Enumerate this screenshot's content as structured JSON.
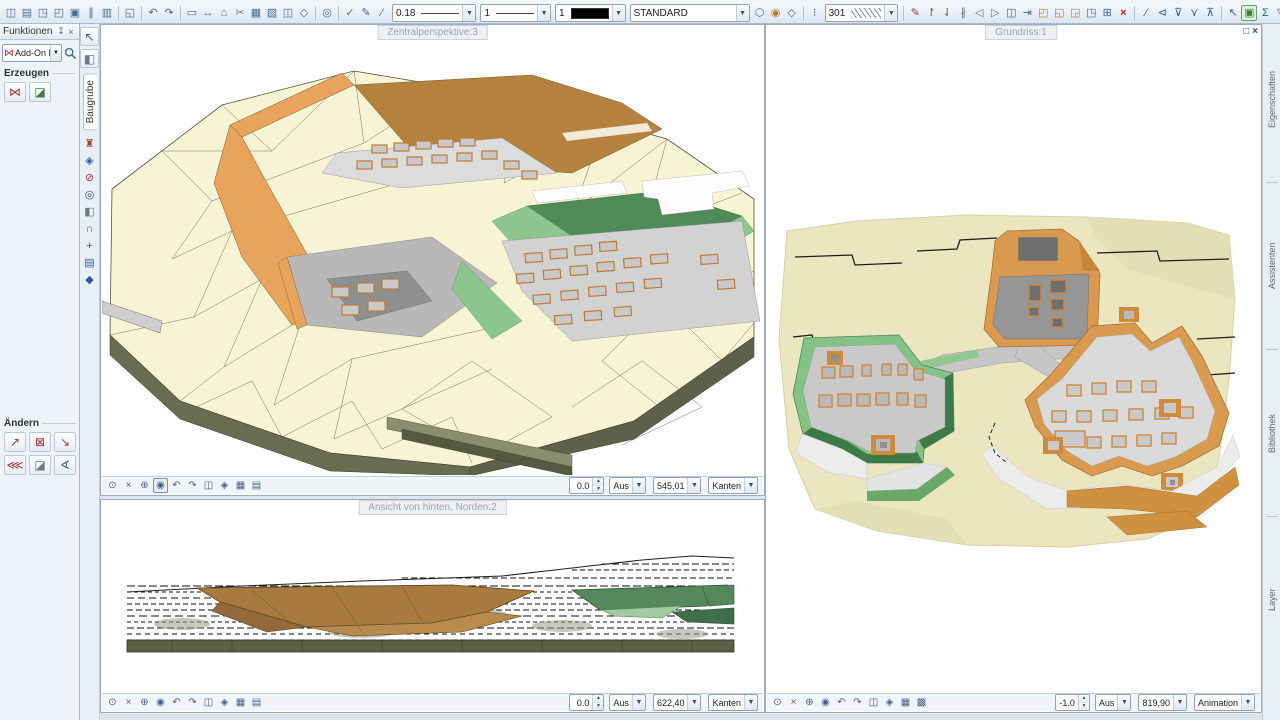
{
  "toolbar": {
    "pen_width": "0.18",
    "line_type": "1",
    "pen_color": "1",
    "layer_name": "STANDARD",
    "hatch_number": "301"
  },
  "palette": {
    "title": "Funktionen",
    "addon_dropdown": "Add-On Modul",
    "section_create": "Erzeugen",
    "section_modify": "Ändern",
    "module_tab": "Baugrube"
  },
  "right_tabs": [
    "Eigenschaften",
    "Assistenten",
    "Bibliothek",
    "Layer"
  ],
  "viewports": [
    {
      "title": "Zentralperspektive:3",
      "tilt": "0.0",
      "mode1": "Aus",
      "scale": "545,01",
      "mode2": "Kanten"
    },
    {
      "title": "Ansicht von hinten, Norden:2",
      "tilt": "0.0",
      "mode1": "Aus",
      "scale": "622,40",
      "mode2": "Kanten"
    },
    {
      "title": "Grundriss:1",
      "tilt": "-1.0",
      "mode1": "Aus",
      "scale": "819,90",
      "mode2": "Animation"
    }
  ],
  "window_buttons": {
    "maximize": "□",
    "close": "×"
  },
  "colors": {
    "terrain": "#f6f3d6",
    "terrain_side": "#6b7054",
    "wall_orange": "#e2a259",
    "plateau_brown": "#b5813f",
    "slab_gray": "#d6d6d6",
    "green_dark": "#4f8a58",
    "green_light": "#8cc68c",
    "toolbar_accent": "#4a6a92",
    "delete_red": "#cc1414"
  },
  "icons": {
    "file": [
      {
        "n": "new-document-icon",
        "g": "◫"
      },
      {
        "n": "open-project-icon",
        "g": "▤"
      },
      {
        "n": "copy-document-icon",
        "g": "◳"
      },
      {
        "n": "open-folder-icon",
        "g": "◰"
      },
      {
        "n": "save-icon",
        "g": "▣"
      },
      {
        "n": "import-export-icon",
        "g": "∥"
      },
      {
        "n": "project-pilot-icon",
        "g": "▥"
      }
    ],
    "screen": [
      {
        "n": "screen-layout-icon",
        "g": "◱"
      }
    ],
    "undoredo": [
      {
        "n": "undo-icon",
        "g": "↶"
      },
      {
        "n": "redo-icon",
        "g": "↷"
      }
    ],
    "clipboard": [
      {
        "n": "ruler-icon",
        "g": "▭"
      },
      {
        "n": "measure-tape-icon",
        "g": "↔"
      },
      {
        "n": "roof-tool-icon",
        "g": "⌂"
      },
      {
        "n": "cut-icon",
        "g": "✂",
        "c": "gray"
      },
      {
        "n": "copy-image-icon",
        "g": "▦"
      },
      {
        "n": "paste-image-icon",
        "g": "▧"
      },
      {
        "n": "paste-special-icon",
        "g": "◫"
      },
      {
        "n": "3d-body-icon",
        "g": "◇"
      }
    ],
    "zoomfind": [
      {
        "n": "find-icon",
        "g": "◎"
      }
    ],
    "pens": [
      {
        "n": "format-check-icon",
        "g": "✓",
        "c": "green"
      },
      {
        "n": "format-pen-icon",
        "g": "✎"
      },
      {
        "n": "format-stroke-icon",
        "g": "∕"
      }
    ],
    "surface": [
      {
        "n": "surface-style-icon",
        "g": "⬡"
      },
      {
        "n": "light-icon",
        "g": "◉",
        "c": "orange"
      },
      {
        "n": "texture-icon",
        "g": "◇"
      }
    ],
    "hatchpre": [
      {
        "n": "hatch-link-icon",
        "g": "⁝",
        "c": "blue"
      }
    ],
    "edit": [
      {
        "n": "edit-pen-icon",
        "g": "✎",
        "c": "red"
      },
      {
        "n": "pin-tool-icon",
        "g": "↾",
        "c": "red"
      },
      {
        "n": "hook-tool-icon",
        "g": "⇃",
        "c": "red"
      },
      {
        "n": "parallel-icon",
        "g": "∦",
        "c": "gray"
      },
      {
        "n": "mirror-left-icon",
        "g": "◁",
        "c": "gray"
      },
      {
        "n": "mirror-right-icon",
        "g": "▷",
        "c": "gray"
      },
      {
        "n": "copy-icon",
        "g": "◫"
      },
      {
        "n": "move-icon",
        "g": "⇥"
      },
      {
        "n": "rotate-icon",
        "g": "◰",
        "c": "orange"
      },
      {
        "n": "copy-mirror-icon",
        "g": "◱",
        "c": "orange"
      },
      {
        "n": "stretch-icon",
        "g": "◲",
        "c": "orange"
      },
      {
        "n": "align-icon",
        "g": "◳"
      },
      {
        "n": "resize-icon",
        "g": "⊞"
      },
      {
        "n": "delete-icon",
        "g": "×",
        "c": "delete"
      }
    ],
    "filter": [
      {
        "n": "filter-pen-icon",
        "g": "∕",
        "c": "blue"
      },
      {
        "n": "filter-assistant-icon",
        "g": "⊲",
        "c": "blue"
      },
      {
        "n": "filter-down-icon",
        "g": "⊽",
        "c": "blue"
      },
      {
        "n": "filter-back-icon",
        "g": "⋎",
        "c": "blue"
      },
      {
        "n": "filter-up-icon",
        "g": "⊼",
        "c": "blue"
      }
    ],
    "select": [
      {
        "n": "select-arrow-icon",
        "g": "↖",
        "c": "blue"
      },
      {
        "n": "select-area-icon",
        "g": "▣",
        "c": "green",
        "sel": true
      },
      {
        "n": "select-sum-icon",
        "g": "Σ",
        "c": "blue"
      },
      {
        "n": "select-filter-icon",
        "g": "▽",
        "c": "blue"
      },
      {
        "n": "select-filter-region-icon",
        "g": "⊽",
        "c": "blue"
      }
    ],
    "palette_create": [
      {
        "n": "dgm-delete-tool-icon",
        "g": "⋈",
        "c": "red"
      },
      {
        "n": "dgm-mesh-tool-icon",
        "g": "◪",
        "c": "green"
      }
    ],
    "palette_modify": [
      {
        "n": "modify-line-icon",
        "g": "↗",
        "c": "red"
      },
      {
        "n": "delete-mesh-icon",
        "g": "⊠",
        "c": "red"
      },
      {
        "n": "modify-point-icon",
        "g": "↘",
        "c": "red"
      },
      {
        "n": "merge-mesh-icon",
        "g": "⋘",
        "c": "red"
      },
      {
        "n": "smooth-mesh-icon",
        "g": "◪",
        "c": "gray"
      },
      {
        "n": "mesh-settings-icon",
        "g": "∢",
        "c": "blue"
      }
    ],
    "strip_top": [
      {
        "n": "pin-strip-icon",
        "g": "↖",
        "c": "blue"
      },
      {
        "n": "library-books-icon",
        "g": "◧",
        "c": "gray"
      }
    ],
    "strip_tools": [
      {
        "n": "furniture-module-icon",
        "g": "♜",
        "c": "red"
      },
      {
        "n": "sphere-module-icon",
        "g": "◈",
        "c": "blue"
      },
      {
        "n": "stop-module-icon",
        "g": "⊘",
        "c": "red"
      },
      {
        "n": "inspect-module-icon",
        "g": "◎",
        "c": "blue"
      },
      {
        "n": "clip-module-icon",
        "g": "◧",
        "c": "gray"
      },
      {
        "n": "magnet-module-icon",
        "g": "∩",
        "c": "red"
      },
      {
        "n": "axis-module-icon",
        "g": "+",
        "c": "blue"
      },
      {
        "n": "list-module-icon",
        "g": "▤",
        "c": "blue"
      },
      {
        "n": "diamond-module-icon",
        "g": "◆",
        "c": "blue"
      }
    ],
    "nav1": [
      {
        "n": "track-view-icon",
        "g": "⊙"
      },
      {
        "n": "fit-view-icon",
        "g": "×"
      },
      {
        "n": "zoom-in-icon",
        "g": "⊕"
      },
      {
        "n": "orbit-view-icon",
        "g": "◉",
        "a": true
      },
      {
        "n": "view-undo-icon",
        "g": "↶"
      },
      {
        "n": "view-redo-icon",
        "g": "↷"
      },
      {
        "n": "print-view-icon",
        "g": "◫"
      },
      {
        "n": "perspective-icon",
        "g": "◈"
      },
      {
        "n": "copy-view-icon",
        "g": "▦"
      },
      {
        "n": "view-list-icon",
        "g": "▤"
      }
    ],
    "nav2": [
      {
        "n": "track-view-icon",
        "g": "⊙"
      },
      {
        "n": "fit-view-icon",
        "g": "×"
      },
      {
        "n": "zoom-in-icon",
        "g": "⊕"
      },
      {
        "n": "orbit-view-icon",
        "g": "◉"
      },
      {
        "n": "view-undo-icon",
        "g": "↶"
      },
      {
        "n": "view-redo-icon",
        "g": "↷"
      },
      {
        "n": "print-view-icon",
        "g": "◫"
      },
      {
        "n": "perspective-icon",
        "g": "◈"
      },
      {
        "n": "copy-view-icon",
        "g": "▦"
      },
      {
        "n": "view-list-icon",
        "g": "▤"
      }
    ],
    "nav3": [
      {
        "n": "track-view-icon",
        "g": "⊙"
      },
      {
        "n": "fit-view-icon",
        "g": "×"
      },
      {
        "n": "zoom-in-icon",
        "g": "⊕"
      },
      {
        "n": "orbit-view-icon",
        "g": "◉"
      },
      {
        "n": "view-undo-icon",
        "g": "↶"
      },
      {
        "n": "view-redo-icon",
        "g": "↷"
      },
      {
        "n": "print-view-icon",
        "g": "◫"
      },
      {
        "n": "perspective-icon",
        "g": "◈"
      },
      {
        "n": "copy-view-icon",
        "g": "▦"
      },
      {
        "n": "grid-view-icon",
        "g": "▩"
      }
    ]
  }
}
